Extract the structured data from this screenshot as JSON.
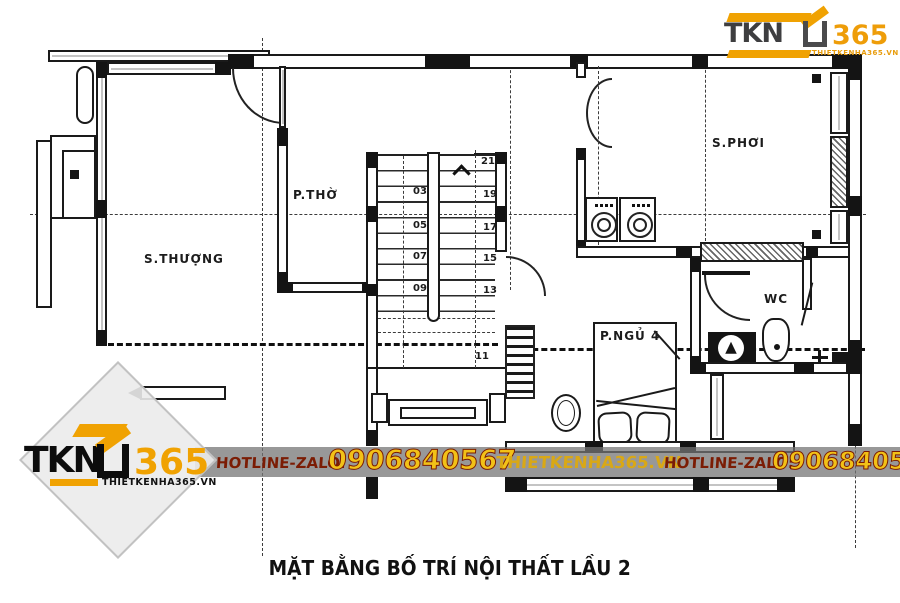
{
  "brand_top": {
    "tkn": "TKN",
    "n365": "365",
    "domain": "THIETKENHA365.VN"
  },
  "watermark": {
    "tkn": "TKN",
    "n365": "365",
    "domain": "THIETKENHA365.VN"
  },
  "band": {
    "label1": "HOTLINE-ZALO:",
    "phone1": "0906840567",
    "site": "THIETKENHA365.VN",
    "label2": "HOTLINE-ZALO:",
    "phone2": "0906840567"
  },
  "plan": {
    "rooms": {
      "s_thuong": "S.THƯỢNG",
      "p_tho": "P.THỜ",
      "s_phoi": "S.PHƠI",
      "wc": "WC",
      "p_ngu4": "P.NGỦ 4"
    },
    "stair": {
      "left": [
        "03",
        "05",
        "07",
        "09"
      ],
      "right": [
        "21",
        "19",
        "17",
        "15",
        "13"
      ],
      "bottom": "11"
    }
  },
  "title": {
    "text": "MẶT BẰNG BỐ TRÍ NỘI THẤT LẦU 2"
  },
  "colors": {
    "accent_orange": "#F0A202",
    "logo_gray": "#3E3E40",
    "band_gold": "#F2C117",
    "band_red": "#7B1C04",
    "band_bg": "rgba(116,116,116,0.74)"
  }
}
